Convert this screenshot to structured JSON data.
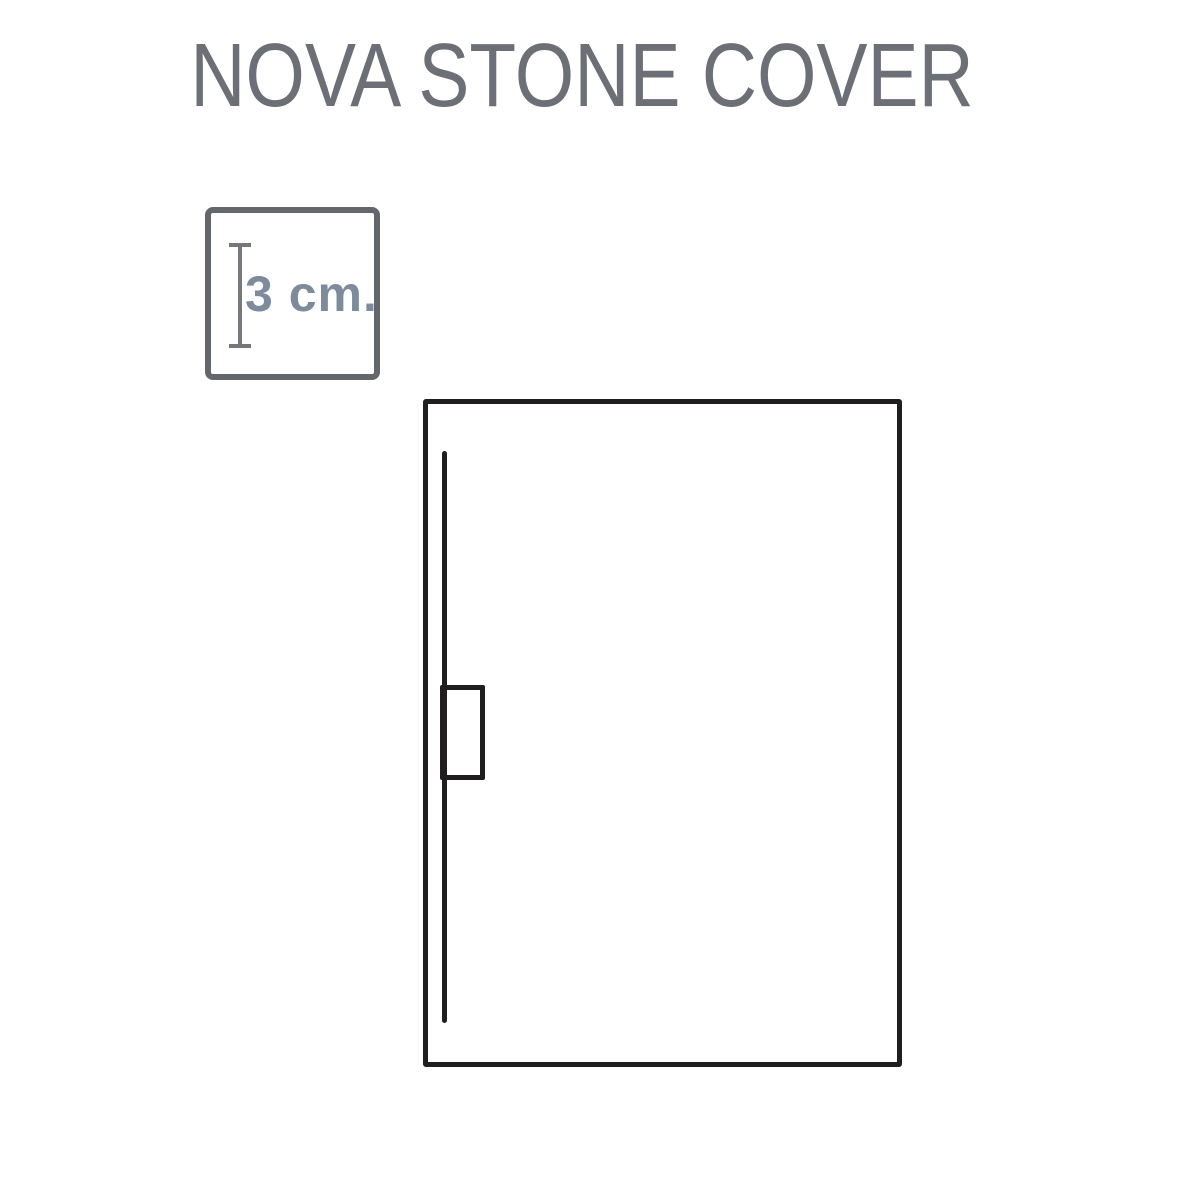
{
  "page": {
    "background_color": "#ffffff",
    "title": "NOVA STONE COVER",
    "title_color": "#6c7076"
  },
  "thickness_badge": {
    "label": "3 cm.",
    "label_color": "#7e8b9c",
    "border_color": "#63666b",
    "measure_icon": "vertical-height-measure-icon",
    "measure_icon_color": "#75787d"
  },
  "tray_diagram": {
    "type": "top-view-technical-drawing",
    "outline_color": "#211e1f",
    "parts": {
      "outline": "tray-outline",
      "channel": "drain-channel-line",
      "outlet": "drain-outlet-box"
    }
  }
}
